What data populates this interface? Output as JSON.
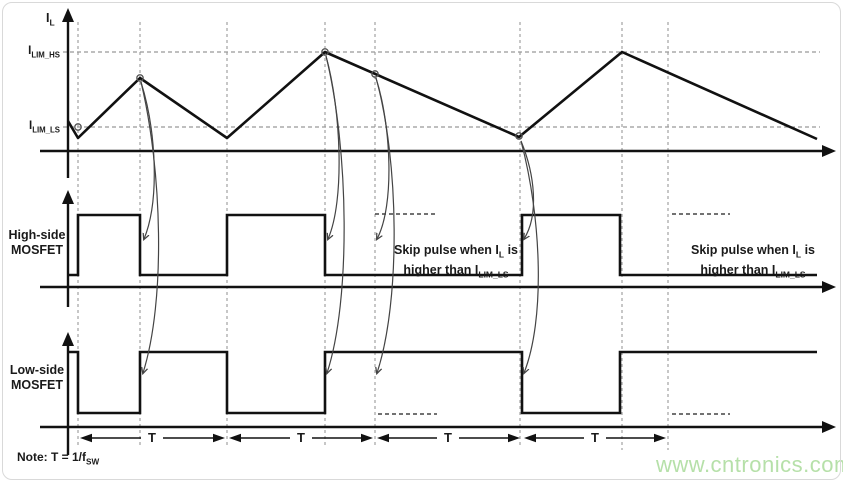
{
  "top_chart": {
    "axis_label": {
      "base": "I",
      "sub": "L"
    },
    "limits": {
      "high": {
        "base": "I",
        "sub": "LIM_HS"
      },
      "low": {
        "base": "I",
        "sub": "LIM_LS"
      }
    }
  },
  "high_side": {
    "label_line1": "High-side",
    "label_line2": "MOSFET"
  },
  "low_side": {
    "label_line1": "Low-side",
    "label_line2": "MOSFET"
  },
  "skip_note": {
    "line1_pre": "Skip pulse when I",
    "line1_sub": "L",
    "line1_post": " is",
    "line2_pre": "higher than I",
    "line2_sub": "LIM_LS"
  },
  "timing": {
    "t_label": "T"
  },
  "note": {
    "pre": "Note: T = 1/f",
    "sub": "SW"
  },
  "watermark": "www.cntronics.com",
  "colors": {
    "waveform": "#1a1a1a",
    "gridline_dash": "#999999",
    "skip_dash": "#444444",
    "callout_arrow": "#444444",
    "watermark_green": "#b6e0a9",
    "frame_border": "#d9d9d9"
  },
  "chart_data": {
    "type": "line",
    "title": "Inductor current pulse-skipping timing diagram",
    "traces": [
      {
        "name": "IL inductor current",
        "vertices_px": [
          [
            68,
            121
          ],
          [
            78,
            138
          ],
          [
            140,
            78
          ],
          [
            227,
            138
          ],
          [
            325,
            52
          ],
          [
            519,
            137
          ],
          [
            622,
            52
          ],
          [
            817,
            139
          ]
        ],
        "event_markers_px": [
          [
            78,
            127
          ],
          [
            140,
            78
          ],
          [
            325,
            52
          ],
          [
            375,
            74
          ],
          [
            519,
            136
          ]
        ],
        "ilim_hs_level_y": 52,
        "ilim_ls_level_y": 127
      },
      {
        "name": "High-side MOSFET gate",
        "on_intervals_x": [
          [
            78,
            140
          ],
          [
            227,
            325
          ],
          [
            522,
            620
          ]
        ],
        "skipped_pulse_dashed_x": [
          [
            375,
            437
          ],
          [
            672,
            730
          ]
        ],
        "high_y": 215,
        "low_y": 275
      },
      {
        "name": "Low-side MOSFET gate",
        "on_intervals_x": [
          [
            68,
            78
          ],
          [
            140,
            227
          ],
          [
            325,
            522
          ],
          [
            620,
            817
          ]
        ],
        "skipped_off_dashed_x": [
          [
            378,
            437
          ],
          [
            672,
            730
          ]
        ],
        "high_y": 352,
        "low_y": 413
      }
    ],
    "period_boundaries_x": [
      78,
      227,
      375,
      522,
      668
    ],
    "period_label": "T",
    "legend_position": "none",
    "grid": "dashed vertical event lines"
  }
}
